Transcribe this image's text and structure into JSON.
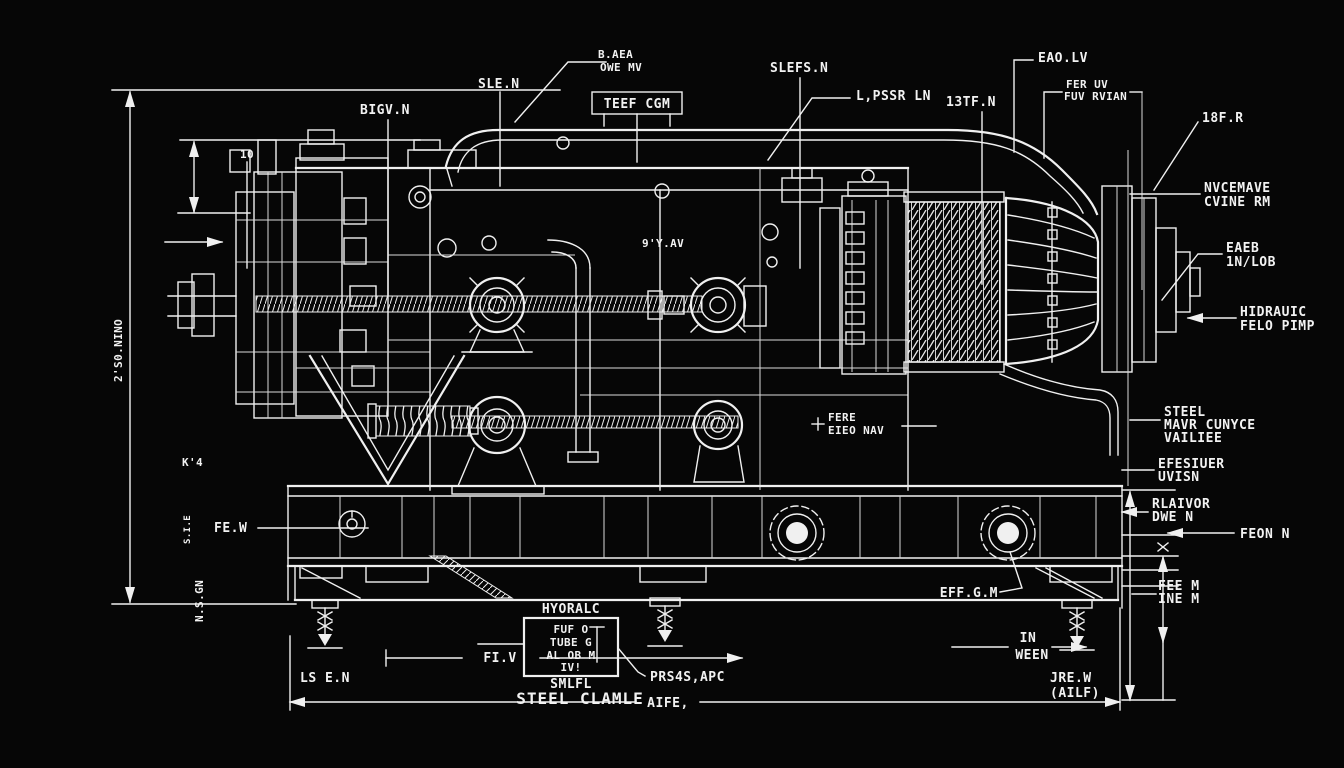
{
  "meta": {
    "type": "engineering-blueprint",
    "background_color": "#060606",
    "ink_color": "#f0f0f0",
    "subject": "industrial winch / cable machine side elevation"
  },
  "labels": {
    "top_owen_1": "B.AEA",
    "top_owen_2": "OWE MV",
    "slefs": "SLEFS.N",
    "teef_box": "TEEF CGM",
    "lpssr": "L,PSSR LN",
    "eao": "EAO.LV",
    "fer_1": "FER UV",
    "fer_2": "FUV RVIAN",
    "f13": "13TF.N",
    "f18": "18F.R",
    "sle": "SLE.N",
    "bigv": "BIGV.N",
    "ten": "10",
    "nine": "9'Y.AV",
    "k4": "K'4",
    "dim_left": "2'S0.NINO",
    "sie": "S.I.E",
    "nsgn": "N.S.GN",
    "few": "FE.W",
    "fere_1": "FERE",
    "fere_2": "EIEO NAV",
    "nvce_1": "NVCEMAVE",
    "nvce_2": "CVINE RM",
    "eaeb_1": "EAEB",
    "eaeb_2": "1N/LOB",
    "hyd_1": "HIDRAUIC",
    "hyd_2": "FELO PIMP",
    "steel_1": "STEEL",
    "steel_2": "MAVR CUNYCE",
    "steel_3": "VAILIEE",
    "efes_1": "EFESIUER",
    "efes_2": "UVISN",
    "rlaivor_1": "RLAIVOR",
    "rlaivor_2": "DWE N",
    "feonn": "FEON N",
    "feem_1": "FEE M",
    "feem_2": "INE M",
    "effgm": "EFF.G.M",
    "in_1": "IN",
    "in_2": "WEEN",
    "jrew_1": "JRE.W",
    "jrew_2": "(AILF)",
    "fiv": "FI.V",
    "lsen": "LS E.N",
    "hyoralc": "HYORALC",
    "box_1": "FUF O",
    "box_2": "TUBE G",
    "box_3": "AL OB M",
    "box_4": "IV!",
    "smlfl": "SMLFL",
    "steel_clamle": "STEEL CLAMLE",
    "prs": "PRS4S,APC",
    "aiee": "AIFE,"
  }
}
